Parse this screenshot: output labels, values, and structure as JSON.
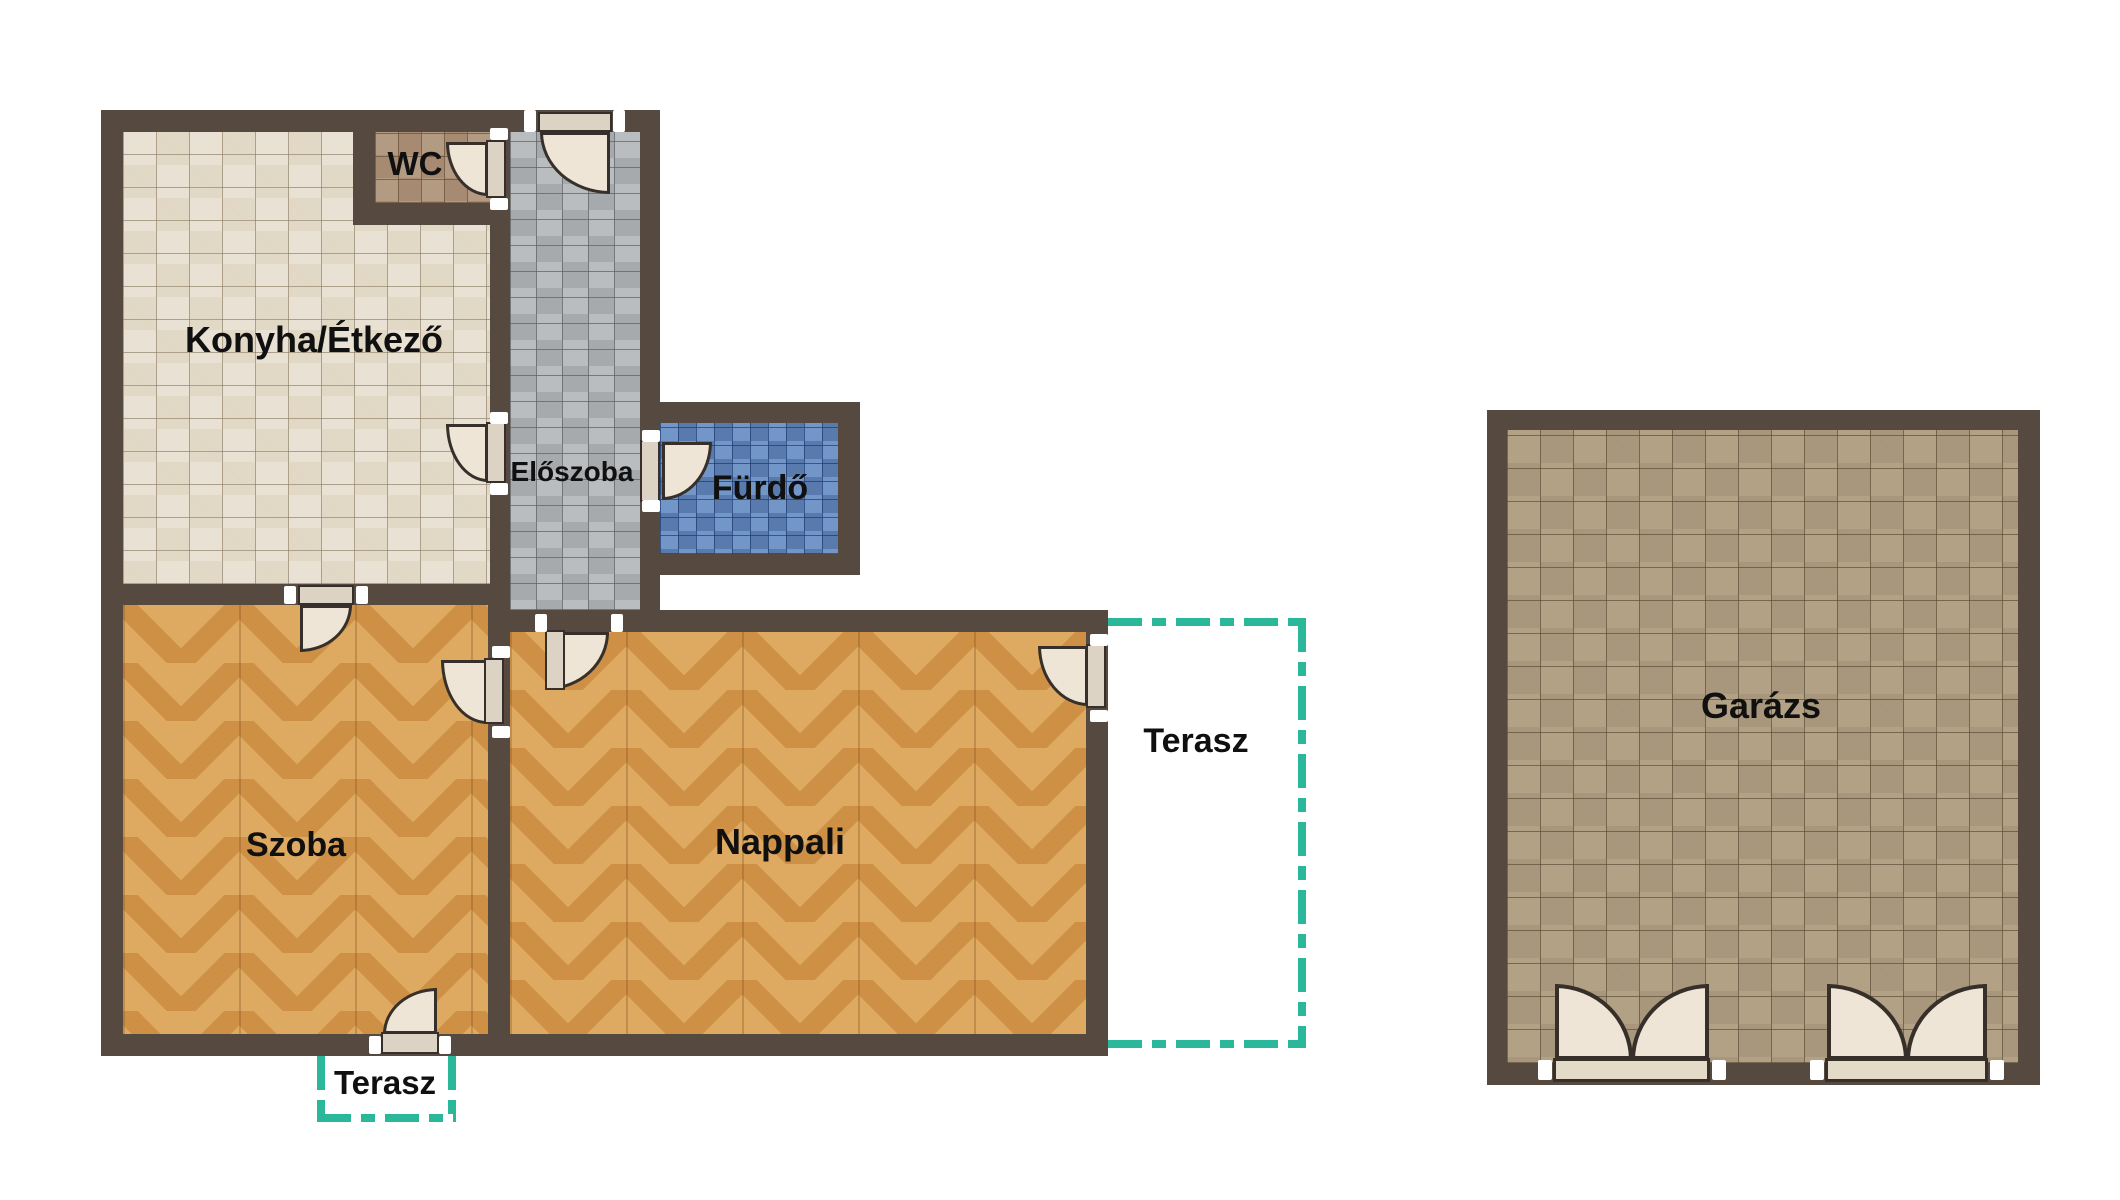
{
  "title": "Lakás alaprajz (floor plan)",
  "rooms": {
    "konyha_etkezo": "Konyha/Étkező",
    "wc": "WC",
    "eloszoba": "Előszoba",
    "furdo": "Fürdő",
    "szoba": "Szoba",
    "nappali": "Nappali",
    "terasz_right": "Terasz",
    "terasz_bottom": "Terasz",
    "garazs": "Garázs"
  },
  "icons": {
    "door_swing": "quarter-circle-door-swing-symbol",
    "double_door": "double-leaf-swing-door-symbol",
    "jamb_bracket": "white-door-jamb-bracket"
  },
  "colors": {
    "background": "#ffffff",
    "wall": "#564940",
    "terrace_dash": "#2bb89a",
    "door_fill": "#eee5d6",
    "door_leaf": "#ddd3c4",
    "label": "#101010",
    "konyha_tile": "#e9e2d4",
    "wc_tile": "#b39a83",
    "corridor_tile": "#babdbf",
    "bath_tile": "#7296c7",
    "wood": "#cd9044",
    "garage_tile": "#b2a185"
  }
}
